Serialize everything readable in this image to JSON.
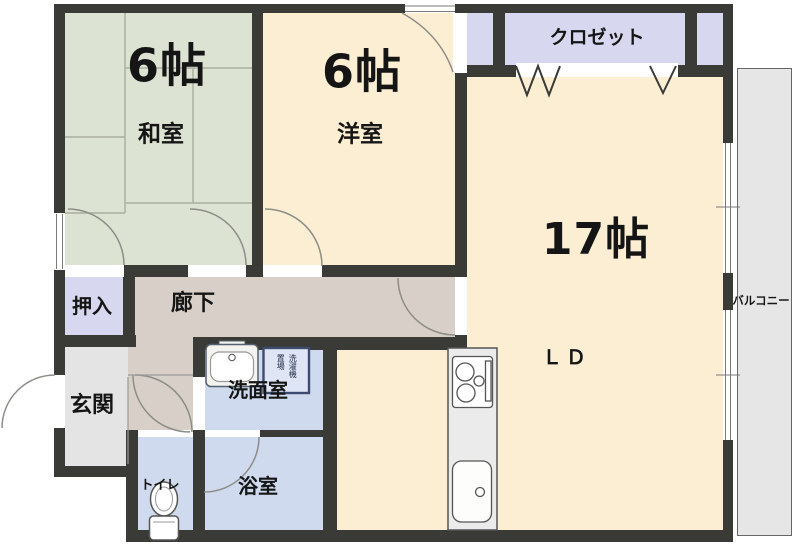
{
  "floorplan": {
    "rooms": {
      "washitsu": {
        "size_label": "6帖",
        "name_label": "和室"
      },
      "yoshitsu": {
        "size_label": "6帖",
        "name_label": "洋室"
      },
      "closet": {
        "name_label": "クロゼット"
      },
      "living_dining": {
        "size_label": "17帖",
        "name_label": "ＬＤ"
      },
      "oshiire": {
        "name_label": "押入"
      },
      "corridor": {
        "name_label": "廊下"
      },
      "genkan": {
        "name_label": "玄関"
      },
      "washroom": {
        "name_label": "洗面室"
      },
      "bathroom": {
        "name_label": "浴室"
      },
      "toilet": {
        "name_label": "トイレ"
      },
      "balcony": {
        "name_label": "バルコニー"
      },
      "laundry_space": {
        "line1": "洗濯機",
        "line2": "置場"
      }
    },
    "icons": [
      "stove-icon",
      "kitchen-sink-icon",
      "vanity-sink-icon",
      "washing-machine-space",
      "toilet-icon",
      "door-swing-arc",
      "folding-door-mark",
      "window"
    ],
    "colors": {
      "wall": "#3a3a37",
      "tatami_room": "#dde3d2",
      "western_room": "#fbeed3",
      "closet": "#d7d7f0",
      "corridor": "#d8d0c8",
      "entrance": "#e4e4e4",
      "wet_rooms": "#cfdaee",
      "balcony": "#e6e6e6",
      "kitchen_counter": "#ebebeb"
    }
  }
}
